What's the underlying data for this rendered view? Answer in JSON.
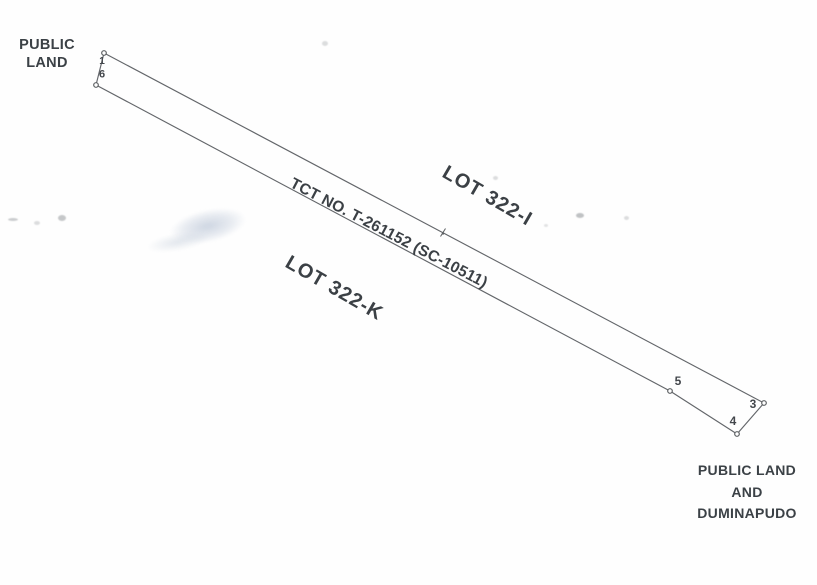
{
  "colors": {
    "ink": "#3b4146",
    "line": "#63666a",
    "marker_stroke": "#5d6063",
    "paper": "#fefefe"
  },
  "corner_labels": {
    "top_left": {
      "lines": [
        "PUBLIC",
        "LAND"
      ]
    },
    "bottom_right": {
      "lines": [
        "PUBLIC LAND",
        "AND",
        "DUMINAPUDO"
      ]
    }
  },
  "lot_labels": {
    "upper": "LOT 322-I",
    "lower": "LOT 322-K"
  },
  "title_line": "TCT NO. T-261152 (SC-10511)",
  "survey": {
    "points": [
      {
        "id": "1",
        "x": 104,
        "y": 53
      },
      {
        "id": "3",
        "x": 764,
        "y": 403
      },
      {
        "id": "4",
        "x": 737,
        "y": 434
      },
      {
        "id": "5",
        "x": 670,
        "y": 391
      },
      {
        "id": "6",
        "x": 96,
        "y": 85
      }
    ],
    "point_labels": [
      {
        "text": "1",
        "x": 102,
        "y": 62,
        "size": 10
      },
      {
        "text": "6",
        "x": 102,
        "y": 75,
        "size": 11
      },
      {
        "text": "5",
        "x": 678,
        "y": 381,
        "size": 12
      },
      {
        "text": "3",
        "x": 753,
        "y": 404,
        "size": 12
      },
      {
        "text": "4",
        "x": 733,
        "y": 421,
        "size": 12
      }
    ],
    "edges": [
      [
        "1",
        "3"
      ],
      [
        "3",
        "4"
      ],
      [
        "4",
        "5"
      ],
      [
        "5",
        "6"
      ],
      [
        "6",
        "1"
      ]
    ],
    "mid_marker": {
      "x": 443,
      "y": 233
    }
  },
  "artifacts": {
    "specks": [
      {
        "x": 8,
        "y": 218,
        "w": 10,
        "h": 3,
        "o": 0.45
      },
      {
        "x": 34,
        "y": 221,
        "w": 6,
        "h": 4,
        "o": 0.3
      },
      {
        "x": 58,
        "y": 215,
        "w": 8,
        "h": 6,
        "o": 0.5
      },
      {
        "x": 576,
        "y": 213,
        "w": 8,
        "h": 5,
        "o": 0.55
      },
      {
        "x": 624,
        "y": 216,
        "w": 5,
        "h": 4,
        "o": 0.3
      },
      {
        "x": 493,
        "y": 176,
        "w": 5,
        "h": 4,
        "o": 0.3
      },
      {
        "x": 322,
        "y": 41,
        "w": 6,
        "h": 5,
        "o": 0.3
      },
      {
        "x": 544,
        "y": 224,
        "w": 4,
        "h": 3,
        "o": 0.25
      }
    ]
  }
}
